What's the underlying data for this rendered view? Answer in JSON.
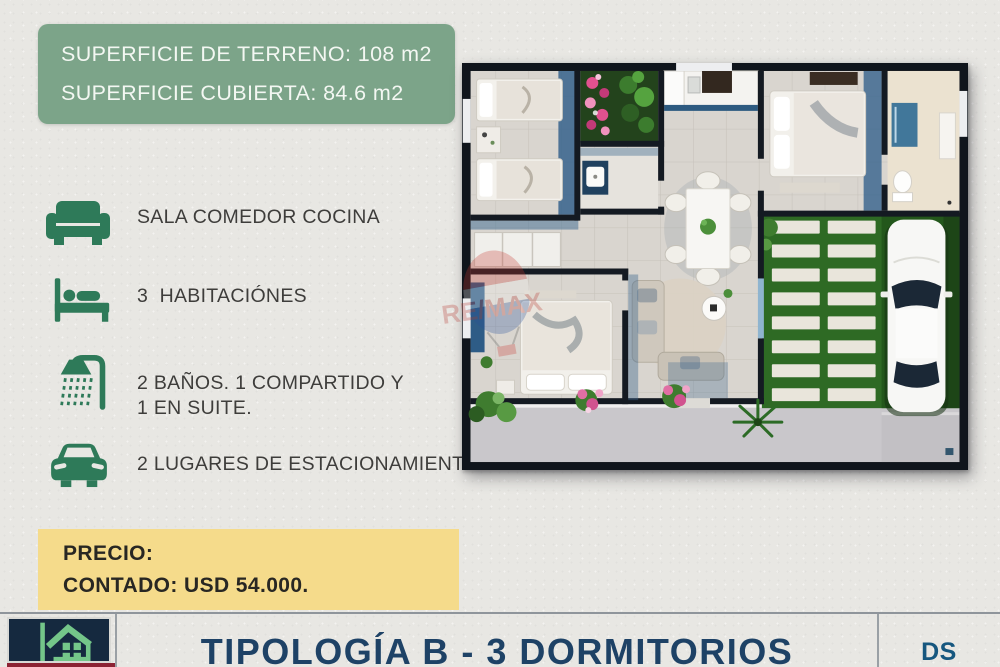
{
  "info_box": {
    "line1": "SUPERFICIE DE TERRENO: 108 m2",
    "line2": "SUPERFICIE CUBIERTA: 84.6 m2"
  },
  "features": [
    {
      "icon": "couch-icon",
      "label": "SALA COMEDOR COCINA"
    },
    {
      "icon": "bed-icon",
      "label": "3  HABITACIÓNES"
    },
    {
      "icon": "shower-icon",
      "label": "2 BAÑOS. 1 COMPARTIDO Y",
      "label2": "1 EN SUITE."
    },
    {
      "icon": "car-icon",
      "label": "2 LUGARES DE ESTACIONAMIENTO"
    }
  ],
  "price_box": {
    "line1": "PRECIO:",
    "line2": "CONTADO: USD 54.000."
  },
  "footer": {
    "title": "TIPOLOGÍA B - 3 DORMITORIOS",
    "brand_initials": "DS"
  },
  "watermark": {
    "text": "RE/MAX"
  },
  "colors": {
    "background": "#E8E7E3",
    "info_box_green": "#7CA489",
    "icon_green": "#2E7A59",
    "price_yellow": "#F5DB8B",
    "title_navy": "#1E4266",
    "ds_blue": "#16577F",
    "logo_navy": "#15293F",
    "logo_green": "#74C689",
    "watermark_red": "#C8372F",
    "watermark_blue": "#27509B"
  }
}
